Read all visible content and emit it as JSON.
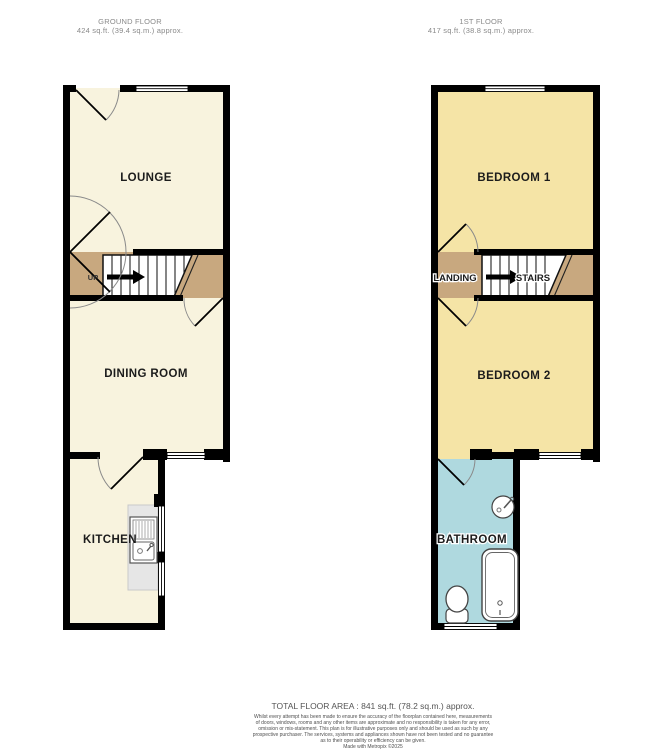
{
  "floors": [
    {
      "title": "GROUND FLOOR",
      "area": "424 sq.ft. (39.4 sq.m.) approx.",
      "labels": {
        "lounge": "LOUNGE",
        "dining_room": "DINING ROOM",
        "kitchen": "KITCHEN",
        "up": "UP"
      }
    },
    {
      "title": "1ST FLOOR",
      "area": "417 sq.ft. (38.8 sq.m.) approx.",
      "labels": {
        "bedroom1": "BEDROOM 1",
        "landing": "LANDING",
        "stairs": "STAIRS",
        "bedroom2": "BEDROOM 2",
        "bathroom": "BATHROOM"
      }
    }
  ],
  "footer": {
    "total_area": "TOTAL FLOOR AREA : 841 sq.ft. (78.2 sq.m.) approx.",
    "disclaimer": [
      "Whilst every attempt has been made to ensure the accuracy of the floorplan contained here, measurements",
      "of doors, windows, rooms and any other items are approximate and no responsibility is taken for any error,",
      "omission or mis-statement. This plan is for illustrative purposes only and should be used as such by any",
      "prospective purchaser. The services, systems and appliances shown have not been tested and no guarantee",
      "as to their operability or efficiency can be given."
    ],
    "credit": "Made with Metropix ©2025"
  },
  "colors": {
    "wall": "#000000",
    "ground_room_fill": "#F8F3DE",
    "bedroom_fill": "#F5E4A6",
    "hall_fill": "#C8A87F",
    "bathroom_fill": "#AFD9DF",
    "counter_fill": "#E6E6E6",
    "header_text": "#8A8A8A",
    "footer_text": "#4F4F4F"
  }
}
